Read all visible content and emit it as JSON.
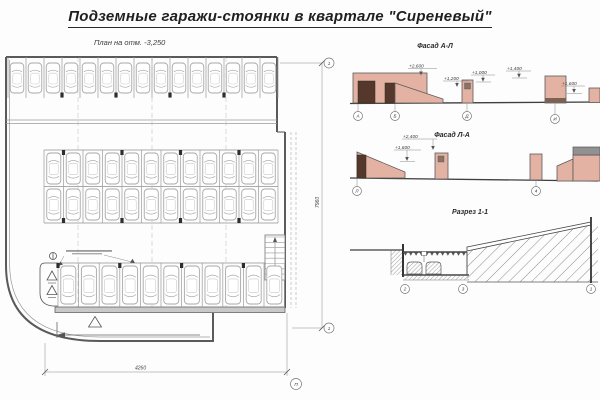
{
  "title": "Подземные гаражи-стоянки в квартале \"Сиреневый\"",
  "plan": {
    "label": "План на отм. -3,250",
    "dim_width": "4260",
    "dim_height": "7960",
    "section_mark_top": "1",
    "section_mark_bottom": "1",
    "axis_bottom": "П",
    "rows": [
      {
        "id": "row-top",
        "count": 15,
        "x0": 8,
        "stall": 18,
        "divTop": 7,
        "divBot": 48,
        "carY": 13,
        "carW": 13.5,
        "carH": 30,
        "columns": [
          3,
          6,
          9,
          12
        ],
        "colY": 42.5
      },
      {
        "id": "row-mid-upper",
        "count": 12,
        "x0": 44,
        "stall": 19.5,
        "divTop": 100,
        "divBot": 136.5,
        "carY": 103,
        "carW": 14,
        "carH": 31,
        "columns": [
          1,
          4,
          7,
          10
        ],
        "colY": 100
      },
      {
        "id": "row-mid-lower",
        "count": 12,
        "x0": 44,
        "stall": 19.5,
        "divTop": 136.5,
        "divBot": 173,
        "carY": 139,
        "carW": 14,
        "carH": 31,
        "columns": [
          1,
          4,
          7,
          10
        ],
        "colY": 168
      },
      {
        "id": "row-bottom",
        "count": 11,
        "x0": 58,
        "stall": 20.6,
        "divTop": 213,
        "divBot": 257,
        "carY": 216,
        "carW": 15,
        "carH": 38,
        "columns": [
          0,
          3,
          6,
          9
        ],
        "colY": 213
      }
    ]
  },
  "f1": {
    "label": "Фасад А-Л",
    "marks": [
      "+2,600",
      "+1,200",
      "+1,000",
      "+1,400",
      "+1,600"
    ],
    "axes": [
      "А",
      "Б",
      "Д",
      "И"
    ]
  },
  "f2": {
    "label": "Фасад Л-А",
    "marks": [
      "+2,400",
      "+1,600"
    ],
    "axes": [
      "Л",
      "4"
    ]
  },
  "sec": {
    "label": "Разрез 1-1",
    "axes": [
      "2",
      "3",
      "1"
    ]
  },
  "colors": {
    "wall_fill": "#e3b2a3",
    "door_fill": "#54382c",
    "roof_fill": "#919191",
    "car_line": "#a8a8a8",
    "title_text": "#1f1f1f"
  }
}
